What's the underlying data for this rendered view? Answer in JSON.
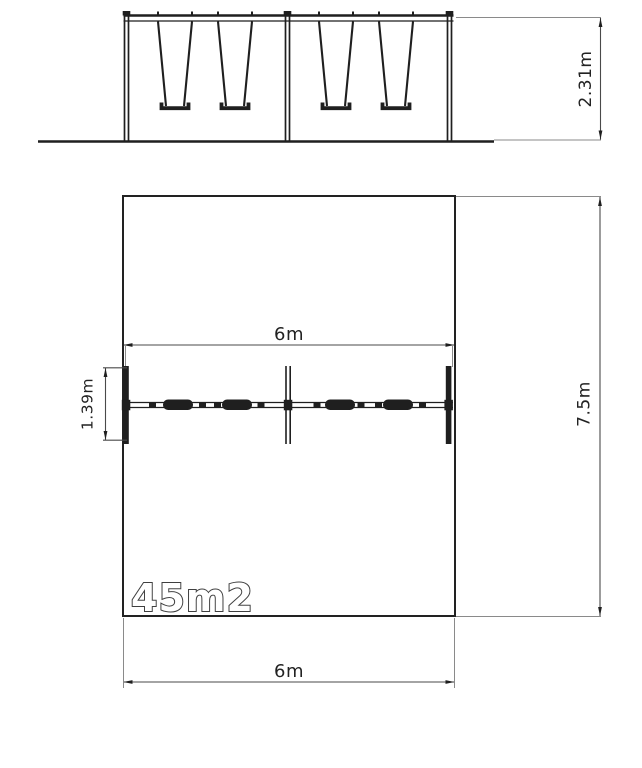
{
  "drawing": {
    "type": "technical drawing - double swing set, front elevation and plan view",
    "dims": {
      "elevation_height": "2.31m",
      "plan_width_top": "6m",
      "plan_width_bottom": "6m",
      "plan_depth": "7.5m",
      "swing_frame_depth": "1.39m"
    },
    "labels": {
      "area": "45m2"
    },
    "colors": {
      "line": "#1f1f1f",
      "dim_line": "#4a4a4a",
      "ext_line": "#8a8a8a",
      "text": "#222222",
      "background": "#ffffff"
    }
  }
}
